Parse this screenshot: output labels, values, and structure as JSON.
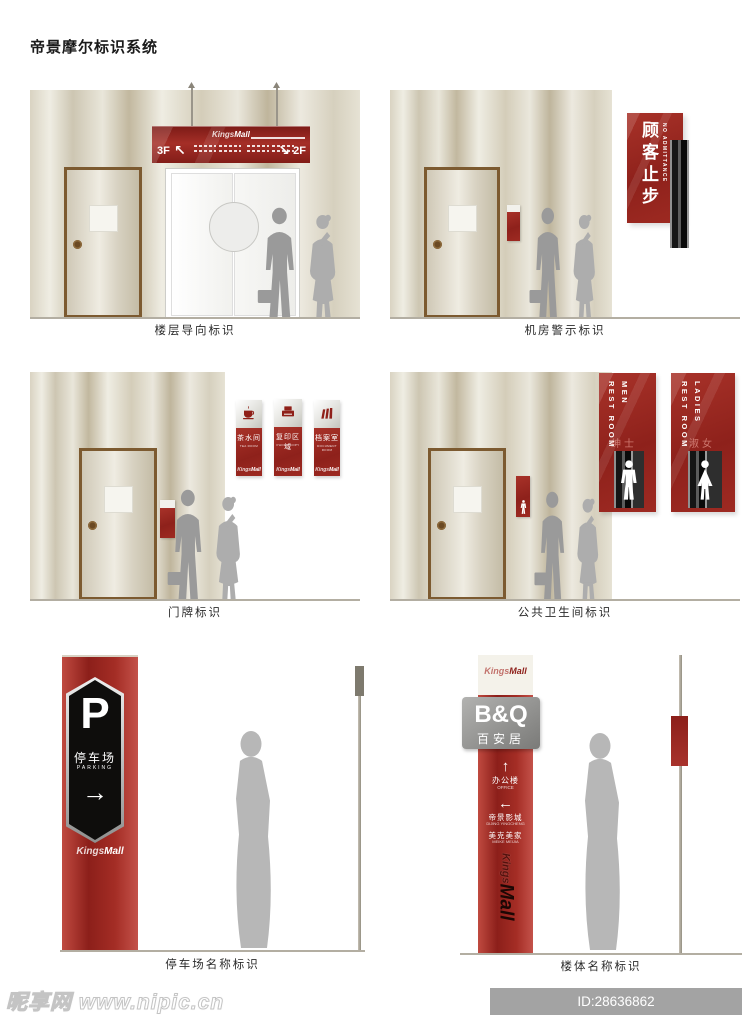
{
  "title": "帝景摩尔标识系统",
  "brand": {
    "kings": "Kings",
    "mall": "Mall"
  },
  "panels": {
    "floor": {
      "caption": "楼层导向标识",
      "left_floor": "3F",
      "left_arrow": "↖",
      "right_arrow": "↘",
      "right_floor": "2F"
    },
    "machine": {
      "caption": "机房警示标识",
      "sign_cn": "顾客止步",
      "sign_en": "NO ADMITTANCE"
    },
    "doorplate": {
      "caption": "门牌标识",
      "signs": [
        {
          "cn": "茶水间",
          "en": "TEA ROOM"
        },
        {
          "cn": "复印区域",
          "en": "PHOTO COPY"
        },
        {
          "cn": "档案室",
          "en": "DOCUMENT ROOM"
        }
      ]
    },
    "restroom": {
      "caption": "公共卫生间标识",
      "men": {
        "line1": "REST ROOM",
        "line2": "MEN",
        "cn": "绅士"
      },
      "ladies": {
        "line1": "REST ROOM",
        "line2": "LADIES",
        "cn": "淑女"
      }
    },
    "parking": {
      "caption": "停车场名称标识",
      "symbol": "P",
      "cn": "停车场",
      "en": "PARKING",
      "arrow": "→"
    },
    "building": {
      "caption": "楼体名称标识",
      "tenant": "B&Q",
      "tenant_cn": "百安居",
      "directions": [
        {
          "arrow": "↑",
          "cn": "办公楼",
          "en": "OFFICE"
        },
        {
          "arrow": "←",
          "cn": "帝景影城",
          "en": "DIJING YINGCHENG"
        },
        {
          "arrow": "",
          "cn": "美克美家",
          "en": "MEIKE MEIJIA"
        }
      ]
    }
  },
  "watermark": {
    "site": "昵享网",
    "url": "www.nipic.cn",
    "code": "ID:28636862 NO:20260124083140171100"
  },
  "colors": {
    "sign_red": "#9e2a23",
    "deep_red": "#7e1c17",
    "wall_tan": "#d8d2c0",
    "silver": "#c9c9c4"
  }
}
